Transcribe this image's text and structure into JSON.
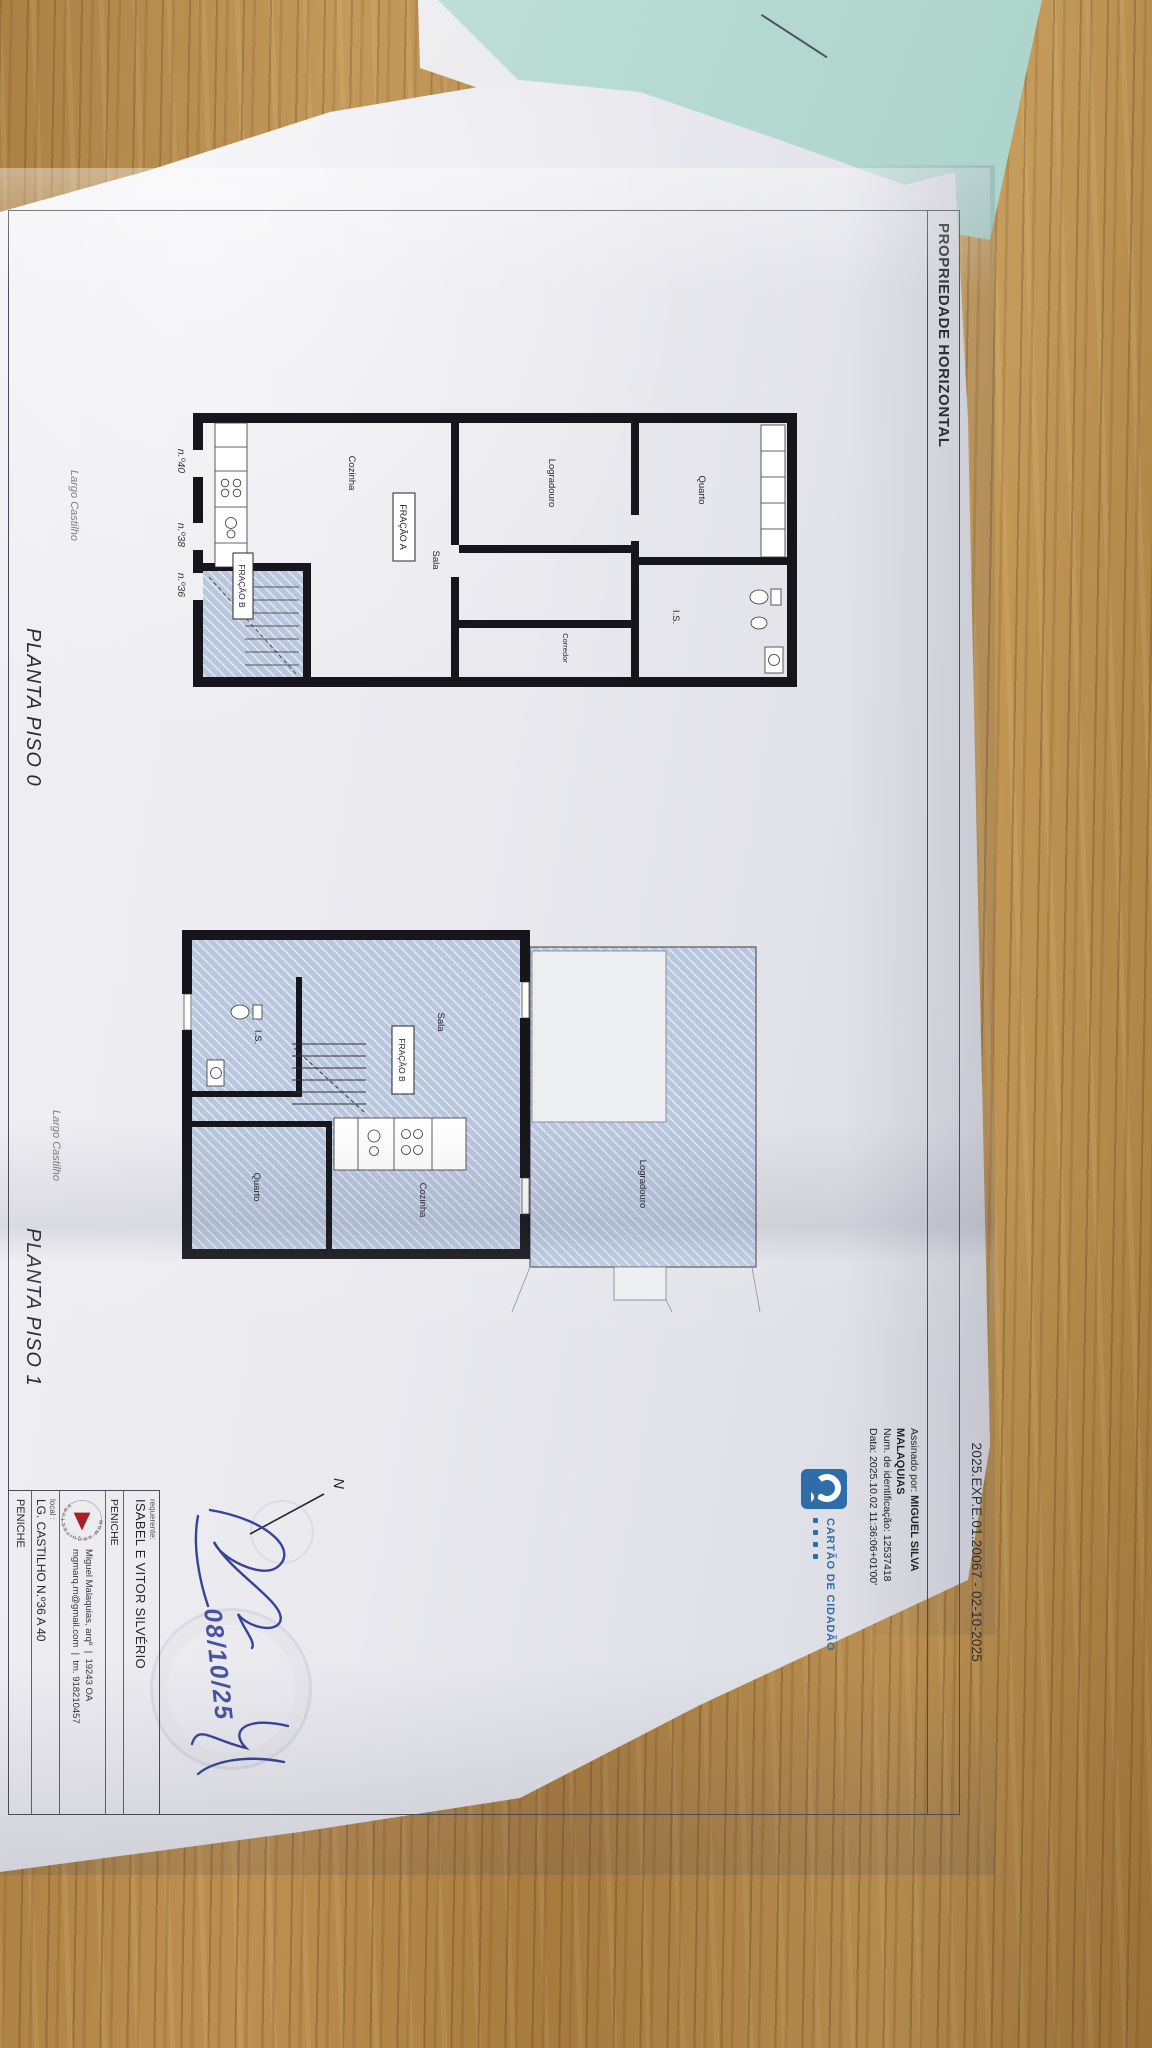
{
  "document": {
    "header_title": "PROPRIEDADE HORIZONTAL",
    "reference": "2025.EXP.E.01.20067 - 02-10-2025",
    "signature_stamp": {
      "prefix": "Assinado por:",
      "name_line1": "MIGUEL SILVA",
      "name_line2": "MALAQUIAS",
      "id_line": "Num. de identificação: 12537418",
      "date_line": "Data: 2025.10.02 11:36:06+01'00'"
    },
    "cc_badge": {
      "label": "CARTÃO DE CIDADÃO"
    },
    "north_label": "N",
    "handwritten_date": "08/10/25"
  },
  "plans": {
    "piso0": {
      "caption": "PLANTA PISO 0",
      "street_label": "Largo Castilho",
      "rooms": {
        "quarto": "Quarto",
        "is": "I.S.",
        "corredor": "Corredor",
        "logradouro": "Logradouro",
        "sala": "Sala",
        "cozinha": "Cozinha"
      },
      "fraction_a": "FRAÇÃO A",
      "fraction_b": "FRAÇÃO B",
      "doors": {
        "n40": "n.º40",
        "n38": "n.º38",
        "n36": "n.º36"
      }
    },
    "piso1": {
      "caption": "PLANTA PISO 1",
      "street_label": "Largo Castilho",
      "rooms": {
        "logradouro": "Logradouro",
        "sala": "Sala",
        "cozinha": "Cozinha",
        "quarto": "Quarto",
        "is": "I.S."
      },
      "fraction_b": "FRAÇÃO B"
    }
  },
  "title_block": {
    "requerente_label": "requerente:",
    "requerente_name": "ISABEL E VITOR SILVÉRIO",
    "requerente_city": "PENICHE",
    "logo_text": "MGM ARQUITECTURA",
    "architect": "Miguel Malaquias, arqº",
    "architect_reg": "19243 OA",
    "email": "mgmarq.m@gmail.com",
    "phone": "tm. 918210457",
    "separator": "|",
    "local_label": "local :",
    "local_value": "LG. CASTILHO N.º36 A 40",
    "local_city": "PENICHE"
  },
  "colors": {
    "wood": "#b8894a",
    "paper": "#e9e9ee",
    "teal_paper": "#bedfd6",
    "cc_blue": "#2e6da8",
    "mgm_red": "#a81f24",
    "ink_blue": "#36429b",
    "wall_black": "#15151b",
    "hatch_blue": "#b9c7de"
  }
}
